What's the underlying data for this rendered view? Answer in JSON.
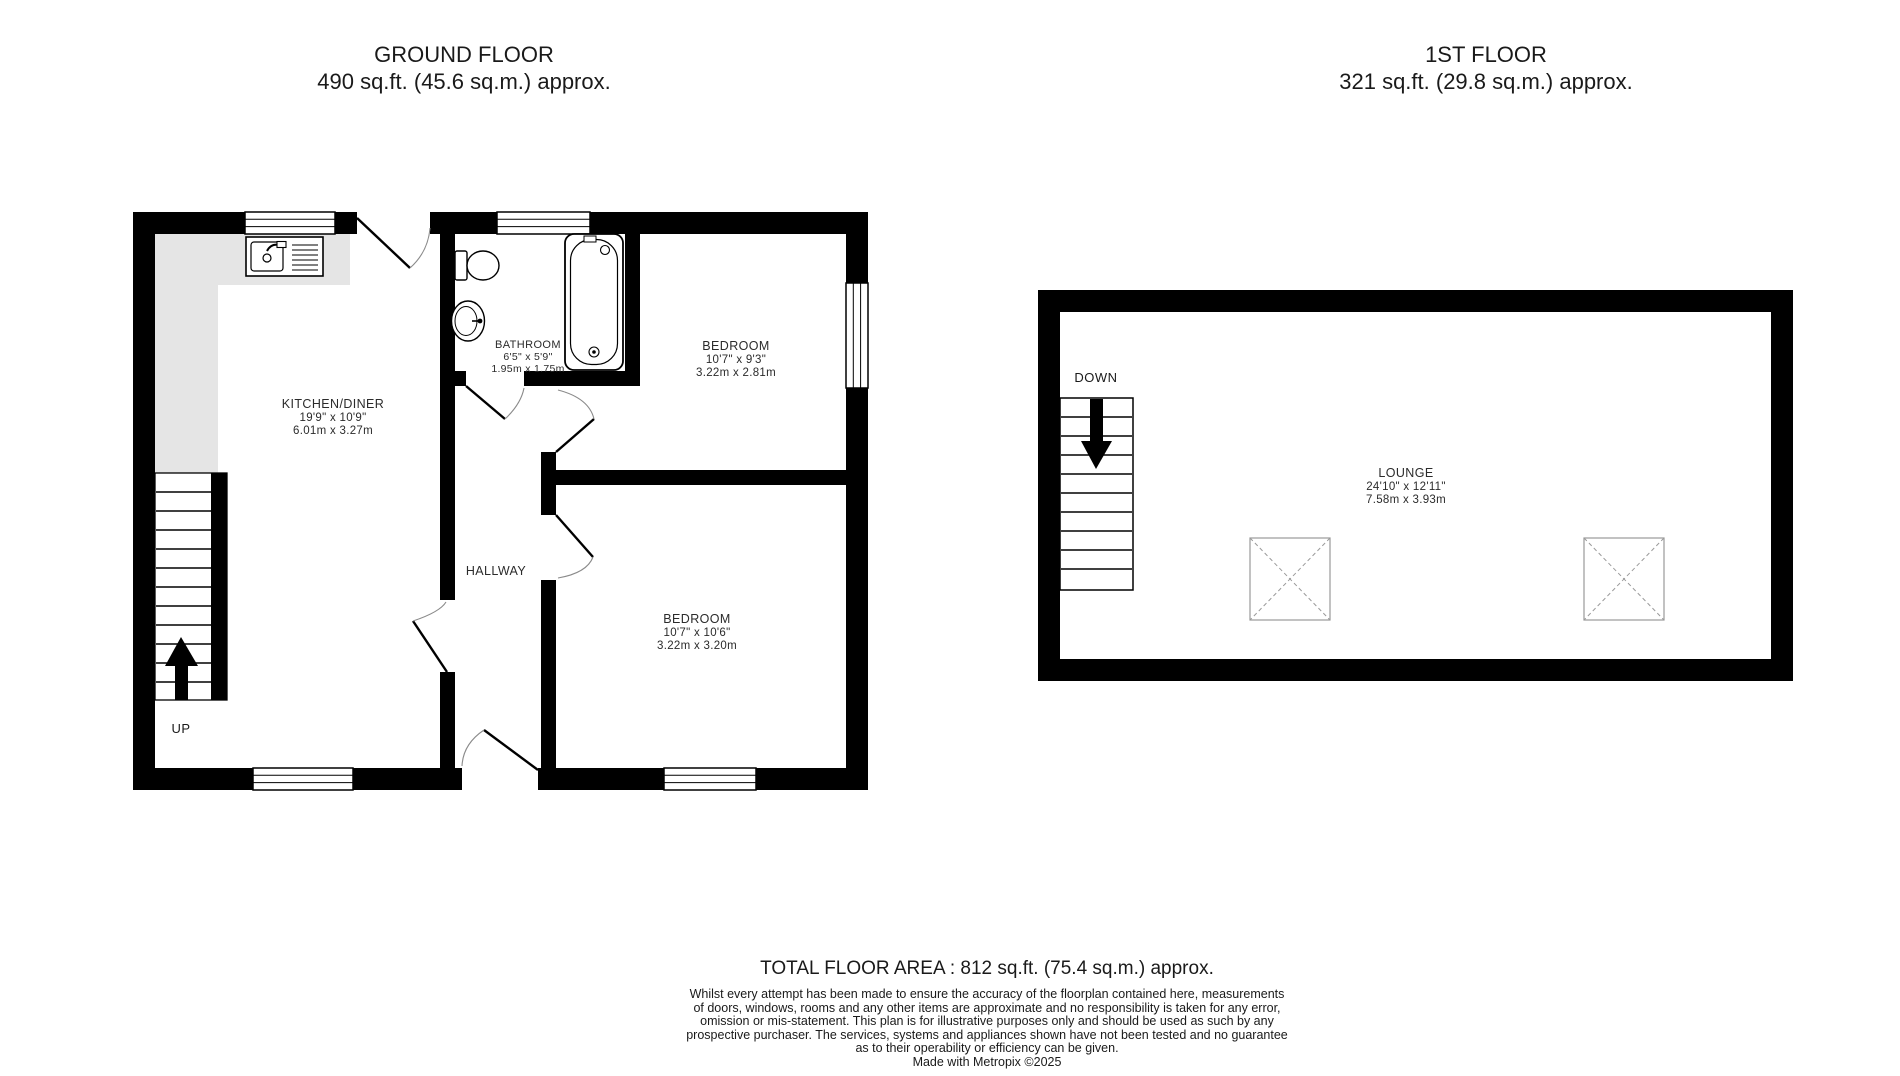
{
  "ground_floor": {
    "title": "GROUND FLOOR",
    "subtitle": "490 sq.ft. (45.6 sq.m.) approx.",
    "stairs_label": "UP",
    "rooms": {
      "kitchen_diner": {
        "name": "KITCHEN/DINER",
        "imperial": "19'9\" x 10'9\"",
        "metric": "6.01m x 3.27m"
      },
      "bathroom": {
        "name": "BATHROOM",
        "imperial": "6'5\" x 5'9\"",
        "metric": "1.95m x 1.75m"
      },
      "bedroom_top": {
        "name": "BEDROOM",
        "imperial": "10'7\" x 9'3\"",
        "metric": "3.22m x 2.81m"
      },
      "hallway": {
        "name": "HALLWAY"
      },
      "bedroom_bottom": {
        "name": "BEDROOM",
        "imperial": "10'7\" x 10'6\"",
        "metric": "3.22m x 3.20m"
      }
    }
  },
  "first_floor": {
    "title": "1ST FLOOR",
    "subtitle": "321 sq.ft. (29.8 sq.m.) approx.",
    "stairs_label": "DOWN",
    "rooms": {
      "lounge": {
        "name": "LOUNGE",
        "imperial": "24'10\" x 12'11\"",
        "metric": "7.58m x 3.93m"
      }
    }
  },
  "footer": {
    "total_area": "TOTAL FLOOR AREA : 812 sq.ft. (75.4 sq.m.) approx.",
    "disclaimer_lines": [
      "Whilst every attempt has been made to ensure the accuracy of the floorplan contained here, measurements",
      "of doors, windows, rooms and any other items are approximate and no responsibility is taken for any error,",
      "omission or mis-statement. This plan is for illustrative purposes only and should be used as such by any",
      "prospective purchaser. The services, systems and appliances shown have not been tested and no guarantee",
      "as to their operability or efficiency can be given.",
      "Made with Metropix ©2025"
    ]
  },
  "colors": {
    "wall": "#000000",
    "counter_fill": "#e5e5e5",
    "dashed_box": "#9a9a9a",
    "door_arc": "#8a8a8a",
    "text": "#1a1a1a"
  }
}
